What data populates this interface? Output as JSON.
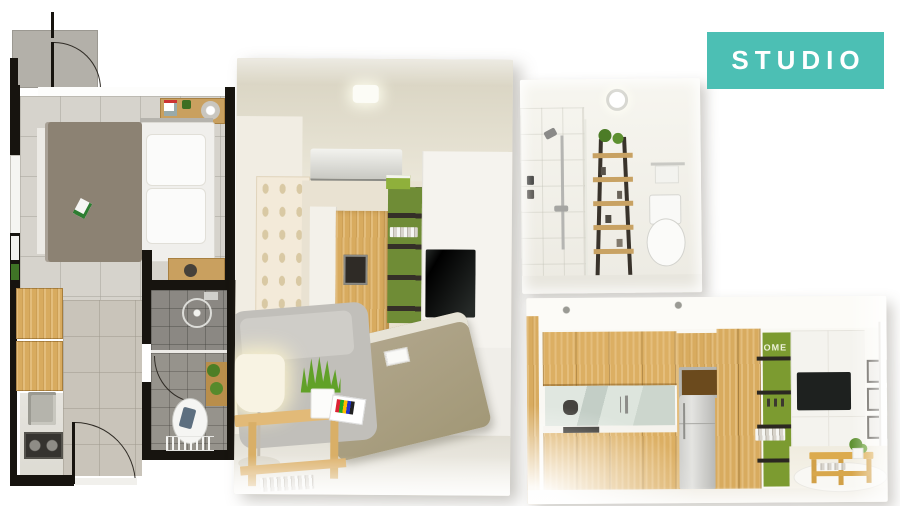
{
  "slide": {
    "title_badge": {
      "label": "STUDIO",
      "background": "#4CBFB4",
      "text_color": "#FFFFFF"
    },
    "kitchen": {
      "shelf_letters": "OME"
    },
    "palette": {
      "accent_teal": "#4CBFB4",
      "cabinet_wood": "#D8AC62",
      "shelf_green": "#7C9B30",
      "blanket_taupe": "#8C8273",
      "plan_wall_black": "#17140F"
    }
  }
}
